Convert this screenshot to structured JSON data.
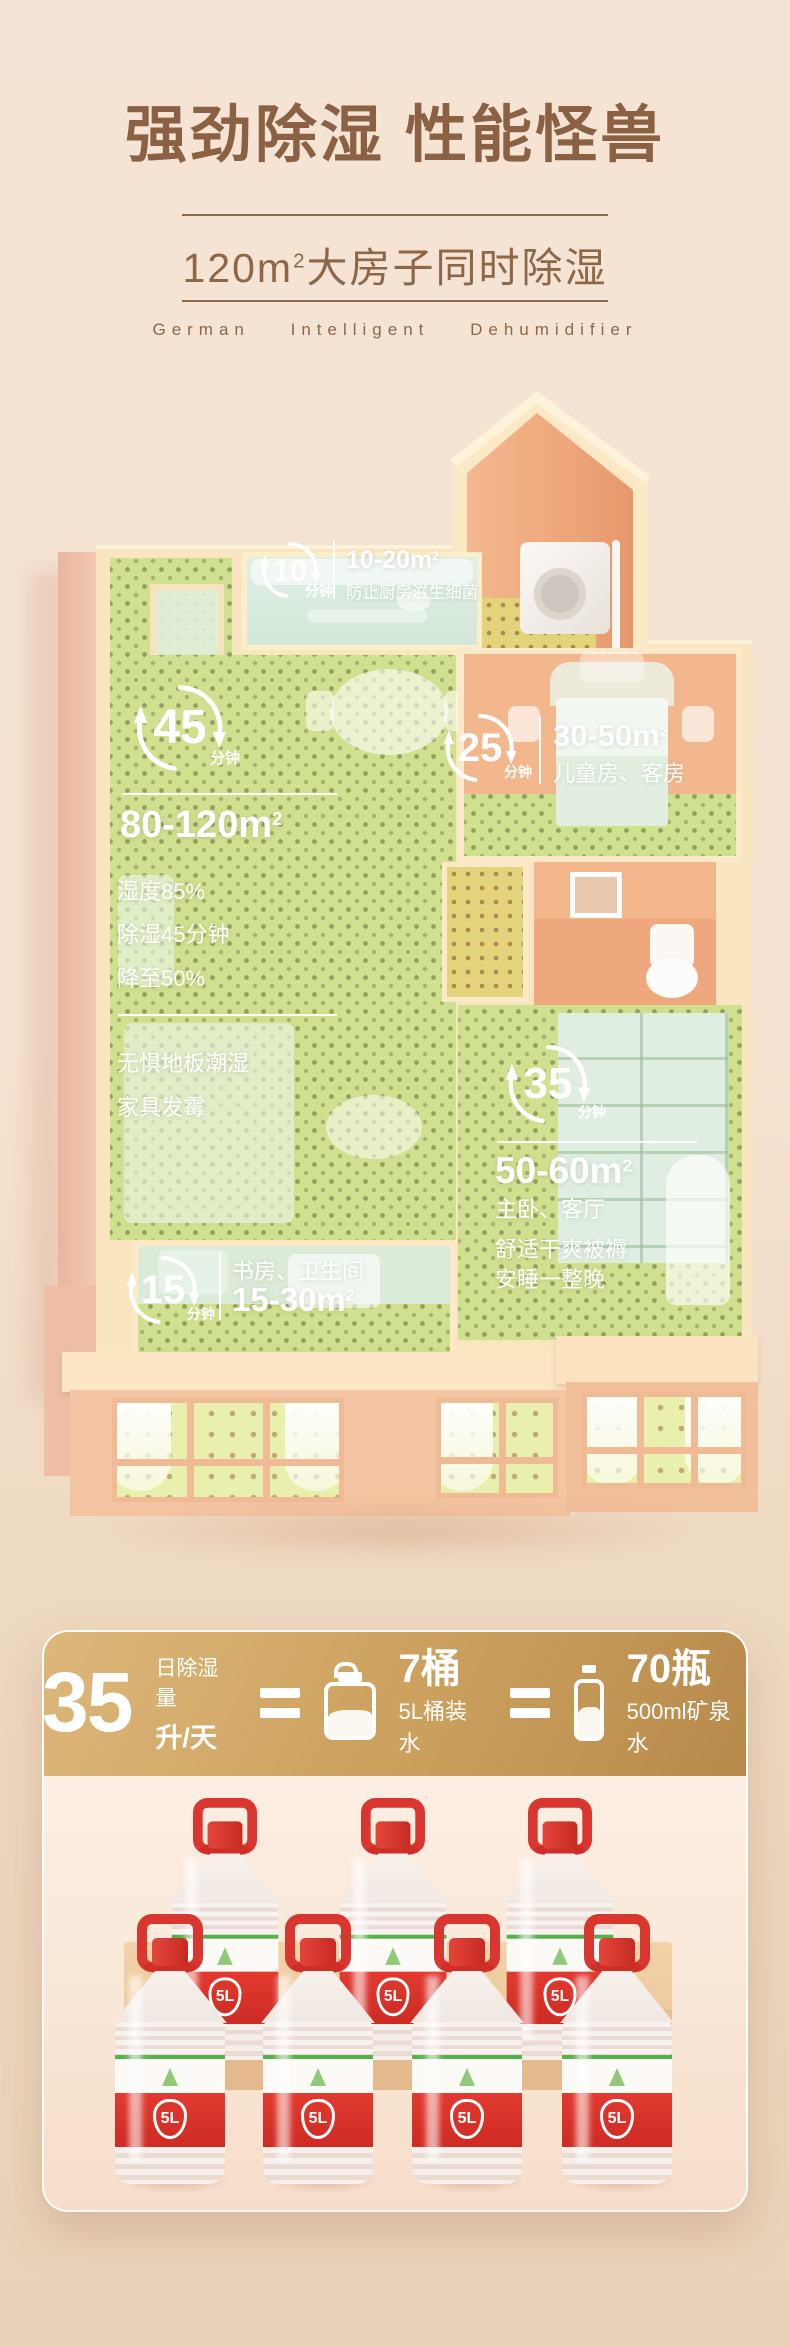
{
  "header": {
    "title": "强劲除湿 性能怪兽",
    "subtitle": {
      "pre": "120m",
      "sup": "2",
      "post": "大房子同时除湿"
    },
    "tagline": "German Intelligent Dehumidifier"
  },
  "floorplan": {
    "zones": [
      {
        "minutes": "10",
        "unit": "分钟",
        "area_pre": "10-20m",
        "area_sup": "2",
        "desc": "防止厨房滋生细菌"
      },
      {
        "minutes": "45",
        "unit": "分钟",
        "area_pre": "80-120m",
        "area_sup": "2",
        "stat1": "湿度85%",
        "stat2": "除湿45分钟",
        "stat3": "降至50%",
        "desc1": "无惧地板潮湿",
        "desc2": "家具发霉"
      },
      {
        "minutes": "25",
        "unit": "分钟",
        "area_pre": "30-50m",
        "area_sup": "2",
        "rooms": "儿童房、客房"
      },
      {
        "minutes": "35",
        "unit": "分钟",
        "area_pre": "50-60m",
        "area_sup": "2",
        "rooms": "主卧、客厅",
        "desc1": "舒适干爽被褥",
        "desc2": "安睡一整晚"
      },
      {
        "minutes": "15",
        "unit": "分钟",
        "rooms": "书房、卫生间",
        "area_pre": "15-30m",
        "area_sup": "2"
      }
    ]
  },
  "capacity": {
    "value": "35",
    "label_top": "日除湿量",
    "label_bottom": "升/天",
    "jug_qty": "7桶",
    "jug_desc": "5L桶装水",
    "bottle_qty": "70瓶",
    "bottle_desc": "500ml矿泉水",
    "bottle_label": "5L"
  },
  "icons": {
    "cycle_arrows": "circular-refresh-arrows",
    "water_jug": "5L-jug-outline-half-filled",
    "water_bottle": "500ml-bottle-outline-half-filled",
    "droplet": "water-drop-outline"
  },
  "colors": {
    "title_brown": "#8a6143",
    "gold_start": "#ddb87b",
    "gold_end": "#b78a4c",
    "bottle_red": "#d8362e",
    "label_green": "#55b14b",
    "floor_green": "#cfe08e",
    "wall_cream": "#f9e6c0",
    "wall_orange": "#f0ab81",
    "facade_peach": "#f4c5a2",
    "bg_top": "#f5e4d5",
    "bg_bottom": "#e9d2b9"
  }
}
